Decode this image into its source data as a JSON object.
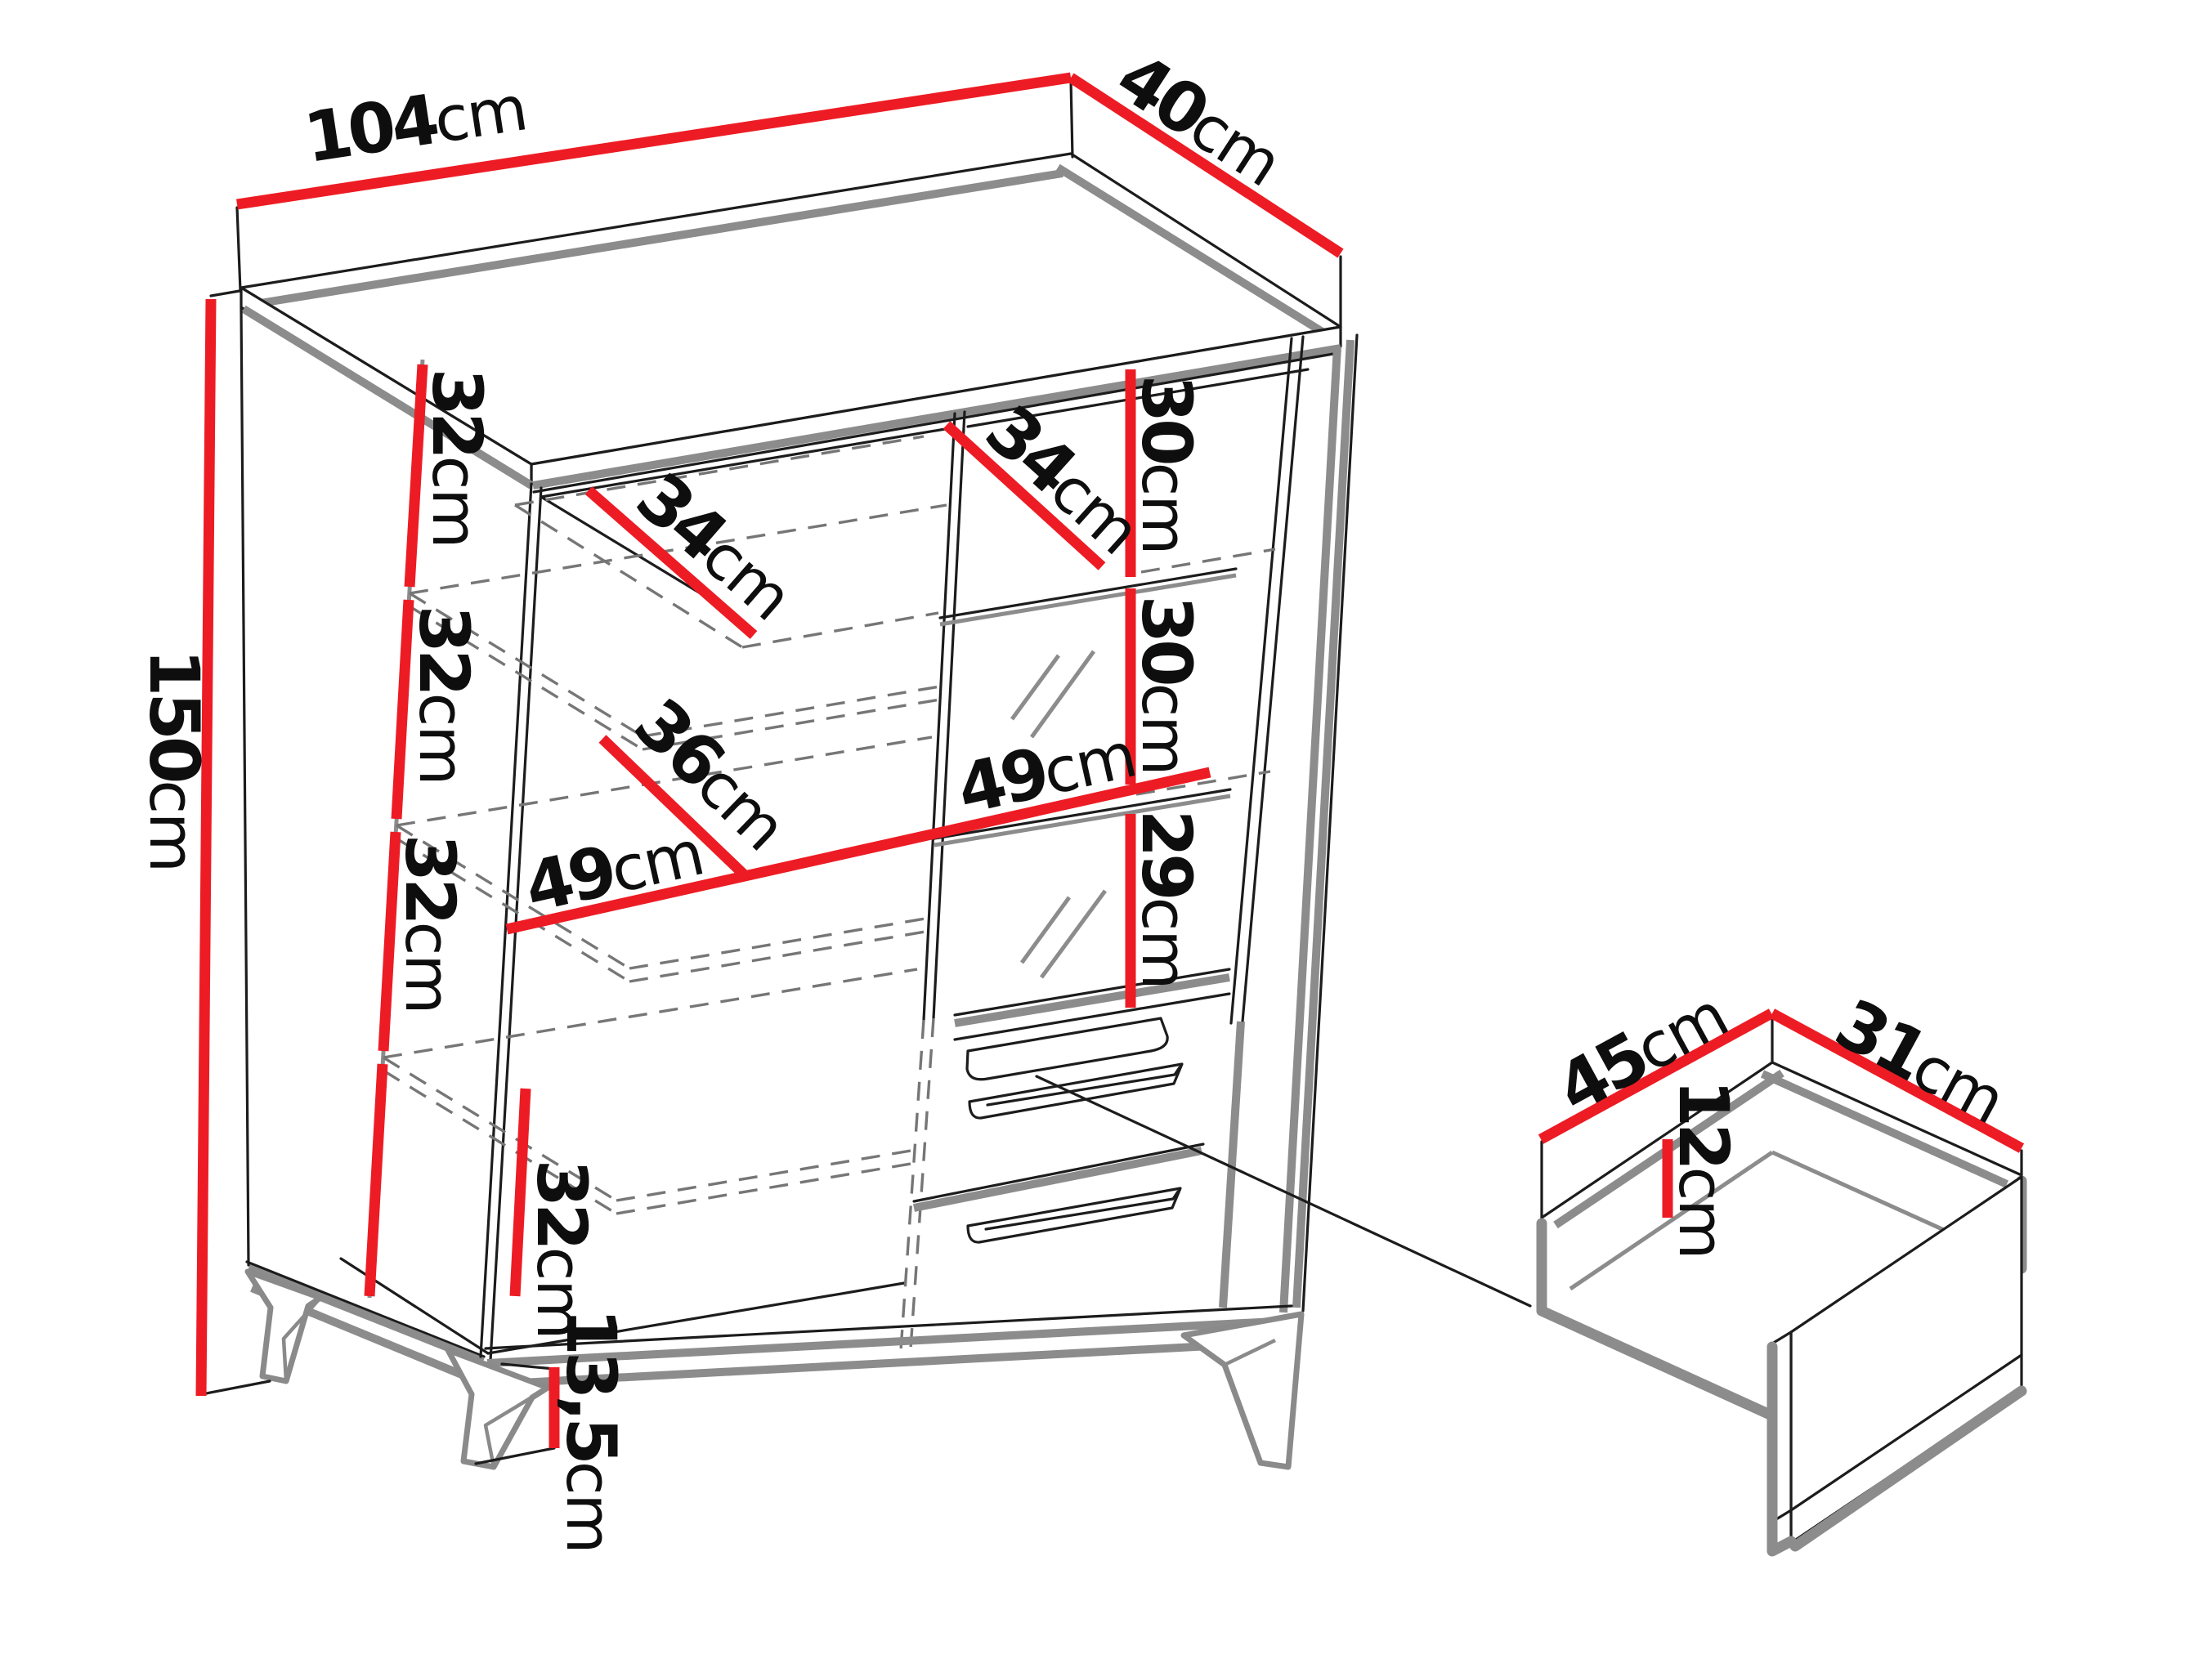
{
  "diagram": {
    "kind": "furniture-dimension-diagram",
    "unit": "cm",
    "accent_color": "#ed1c24",
    "outline_color": "#1c1c1c",
    "shadow_color": "#8c8c8c"
  },
  "cabinet": {
    "overall_width": {
      "num": "104",
      "unit": "cm"
    },
    "overall_depth": {
      "num": "40",
      "unit": "cm"
    },
    "overall_height": {
      "num": "150",
      "unit": "cm"
    },
    "leg_height": {
      "num": "13,5",
      "unit": "cm"
    },
    "left_section": {
      "gaps": [
        {
          "num": "32",
          "unit": "cm"
        },
        {
          "num": "32",
          "unit": "cm"
        },
        {
          "num": "32",
          "unit": "cm"
        },
        {
          "num": "32",
          "unit": "cm"
        }
      ],
      "top_shelf_depth": {
        "num": "34",
        "unit": "cm"
      },
      "mid_shelf_depth": {
        "num": "36",
        "unit": "cm"
      },
      "inner_width": {
        "num": "49",
        "unit": "cm"
      }
    },
    "right_section": {
      "top_shelf_depth": {
        "num": "34",
        "unit": "cm"
      },
      "gaps": [
        {
          "num": "30",
          "unit": "cm"
        },
        {
          "num": "30",
          "unit": "cm"
        },
        {
          "num": "29",
          "unit": "cm"
        }
      ],
      "inner_width": {
        "num": "49",
        "unit": "cm"
      }
    }
  },
  "drawer_detail": {
    "inner_width": {
      "num": "45",
      "unit": "cm"
    },
    "inner_depth": {
      "num": "31",
      "unit": "cm"
    },
    "inner_height": {
      "num": "12",
      "unit": "cm"
    }
  }
}
